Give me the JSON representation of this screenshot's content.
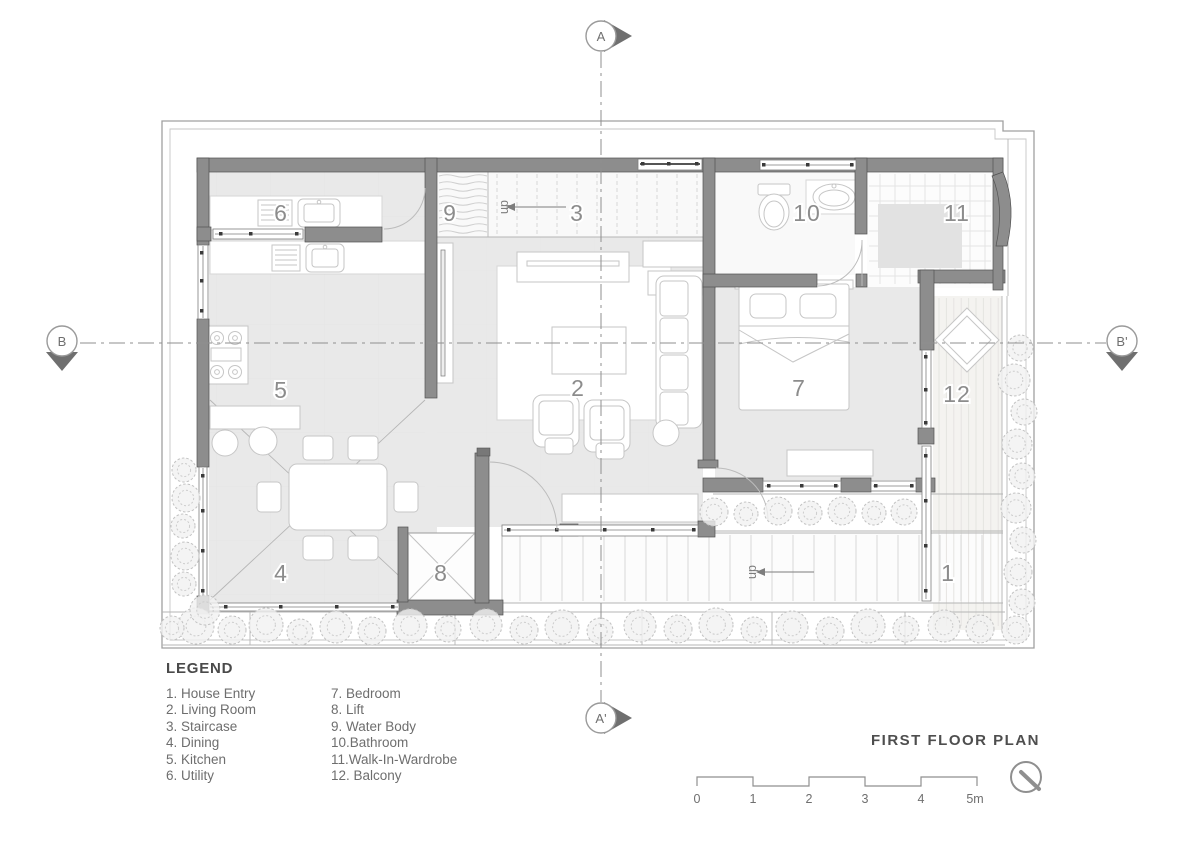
{
  "page": {
    "title": "FIRST FLOOR PLAN"
  },
  "section_markers": {
    "top": "A",
    "bottom": "A'",
    "left": "B",
    "right": "B'"
  },
  "rooms": [
    {
      "number": "1",
      "name": "House Entry"
    },
    {
      "number": "2",
      "name": "Living Room"
    },
    {
      "number": "3",
      "name": "Staircase"
    },
    {
      "number": "4",
      "name": "Dining"
    },
    {
      "number": "5",
      "name": "Kitchen"
    },
    {
      "number": "6",
      "name": "Utility"
    },
    {
      "number": "7",
      "name": "Bedroom"
    },
    {
      "number": "8",
      "name": "Lift"
    },
    {
      "number": "9",
      "name": "Water Body"
    },
    {
      "number": "10",
      "name": "Bathroom"
    },
    {
      "number": "11",
      "name": "Walk-In-Wardrobe"
    },
    {
      "number": "12",
      "name": "Balcony"
    }
  ],
  "annotations": {
    "stair_up_interior": "up",
    "stair_up_entry": "up"
  },
  "legend": {
    "heading": "LEGEND",
    "column1": [
      "1. House Entry",
      "2. Living Room",
      "3. Staircase",
      "4. Dining",
      "5. Kitchen",
      "6. Utility"
    ],
    "column2": [
      "7. Bedroom",
      "8. Lift",
      "9. Water Body",
      "10.Bathroom",
      "11.Walk-In-Wardrobe",
      "12. Balcony"
    ]
  },
  "scale_bar": {
    "ticks": [
      "0",
      "1",
      "2",
      "3",
      "4",
      "5m"
    ]
  },
  "colors": {
    "wall": "#8d8d8d",
    "floor": "#e9e9e9",
    "boundary": "#a0a0a0",
    "label_text": "#8c8c8c",
    "dark_text": "#4e4e4e",
    "body_text": "#6e6e6e"
  }
}
